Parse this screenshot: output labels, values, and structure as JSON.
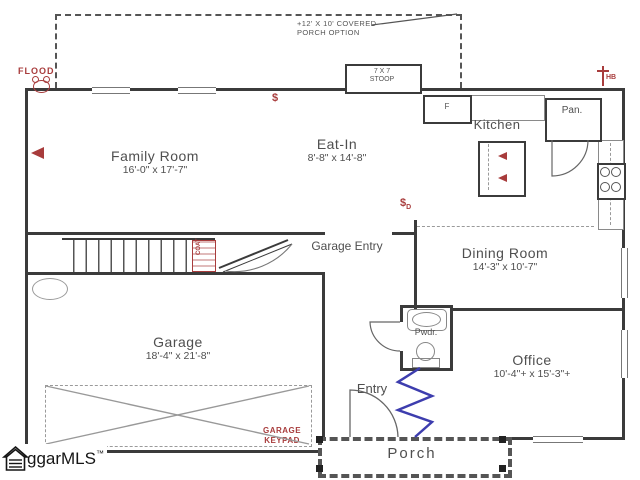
{
  "colors": {
    "wall": "#3b3b3b",
    "annotation_red": "#a83c3c",
    "option_blue": "#3d3dae",
    "text": "#4f4f4f"
  },
  "rooms": {
    "family": {
      "name": "Family Room",
      "dims": "16'-0\" x 17'-7\""
    },
    "eatin": {
      "name": "Eat-In",
      "dims": "8'-8\" x 14'-8\""
    },
    "kitchen": {
      "name": "Kitchen"
    },
    "pantry": {
      "name": "Pan."
    },
    "fridge": {
      "name": "F"
    },
    "dining": {
      "name": "Dining Room",
      "dims": "14'-3\" x 10'-7\""
    },
    "garage_entry": {
      "name": "Garage Entry"
    },
    "garage": {
      "name": "Garage",
      "dims": "18'-4\" x 21'-8\""
    },
    "pwdr": {
      "name": "Pwdr."
    },
    "office": {
      "name": "Office",
      "dims": "10'-4\"+ x 15'-3\"+"
    },
    "entry": {
      "name": "Entry"
    },
    "porch": {
      "name": "Porch"
    }
  },
  "annotations": {
    "covered_porch_l1": "+12' X 10' COVERED",
    "covered_porch_l2": "PORCH OPTION",
    "stoop_l1": "7 X 7",
    "stoop_l2": "STOOP",
    "flood": "FLOOD",
    "hose_bib": "HB",
    "switch_entry": "$",
    "switch_dining": "$",
    "switch_dining_sub": "D",
    "coat": "COAT",
    "garage_keypad_l1": "GARAGE",
    "garage_keypad_l2": "KEYPAD"
  },
  "icons": {
    "flood_light": "circle-with-two-knobs",
    "hose_bib": "tee-symbol",
    "tv_outlet": "left-red-triangle",
    "island_fixtures": "two-left-red-triangles",
    "range": "four-burner-circles",
    "logo_house": "house-outline-with-list-lines"
  },
  "logo": {
    "text": "ggarMLS",
    "tm": "™"
  }
}
